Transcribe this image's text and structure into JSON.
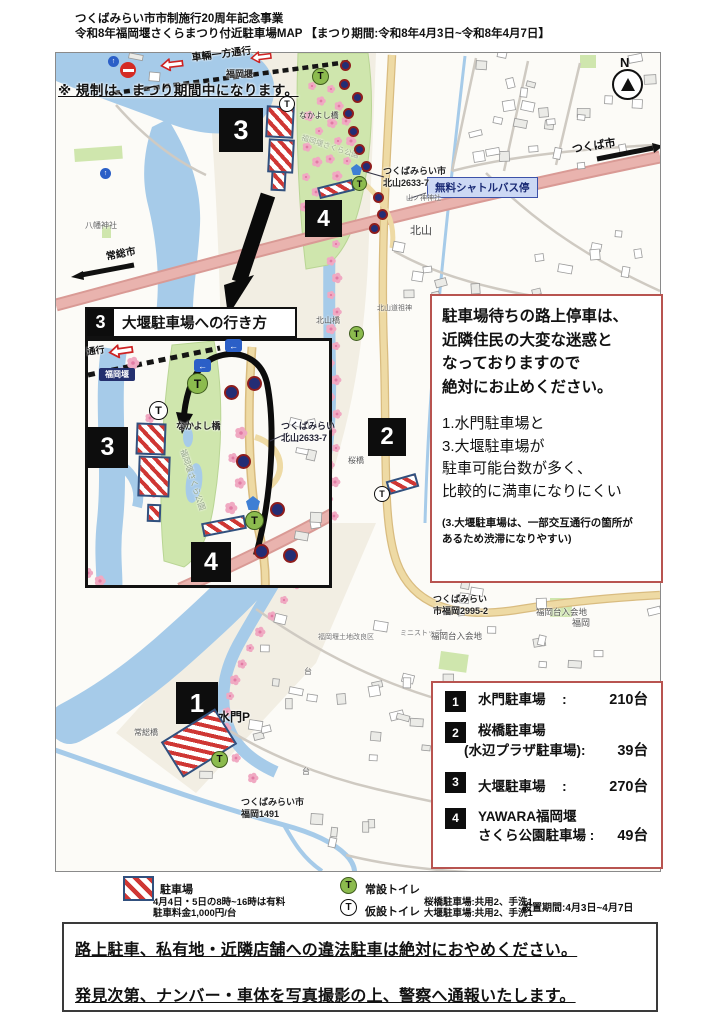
{
  "colors": {
    "accent_red_border": "#b85450",
    "badge_black": "#0d0d0d",
    "river_blue": "#a6cbe9",
    "park_green": "#cfe6ad",
    "highway_pink": "#e9b3ae",
    "road_yellow": "#eedaa4",
    "sakura_pink": "#f0a9c2",
    "hatch_red": "#cf3734",
    "toilet_green": "#8cbb4e",
    "shuttle_bg": "#ccd8f4",
    "shuttle_border": "#3c51a8"
  },
  "header": {
    "line1": "つくばみらい市市制施行20周年記念事業",
    "line2": "令和8年福岡堰さくらまつり付近駐車場MAP 【まつり期間:令和8年4月3日~令和8年4月7日】"
  },
  "map": {
    "restriction_note": "※ 規制は、まつり期間中になります。",
    "one_way_label": "車輛一方通行",
    "shuttle_stop": "無料シャトルバス停",
    "compass": "N",
    "badges": [
      "1",
      "2",
      "3",
      "4"
    ],
    "labels": [
      {
        "name": "fukuoka-weir",
        "text": "福岡堰"
      },
      {
        "name": "nakayoshi-bridge",
        "text": "なかよし橋"
      },
      {
        "name": "sakura-park",
        "text": "福岡堰さくら公園"
      },
      {
        "name": "address-kitayama",
        "text": "つくばみらい市\n北山2633-7"
      },
      {
        "name": "tsukuba-city",
        "text": "つくば市"
      },
      {
        "name": "kitayama",
        "text": "北山"
      },
      {
        "name": "yamanokami-shrine",
        "text": "山ノ神神社"
      },
      {
        "name": "hachiman-shrine",
        "text": "八幡神社"
      },
      {
        "name": "joso-city",
        "text": "常総市"
      },
      {
        "name": "kitayama-bridge",
        "text": "北山橋"
      },
      {
        "name": "kitayama-dosojin",
        "text": "北山道祖神"
      },
      {
        "name": "sakura-bridge",
        "text": "桜橋"
      },
      {
        "name": "address-fukuoka2995",
        "text": "つくばみらい\n市福岡2995-2"
      },
      {
        "name": "ministop",
        "text": "ミニストップ"
      },
      {
        "name": "fukuokadai-iriaichi-1",
        "text": "福岡台入会地"
      },
      {
        "name": "fukuokadai-iriaichi-2",
        "text": "福岡台入会地"
      },
      {
        "name": "fukuoka",
        "text": "福岡"
      },
      {
        "name": "land-improvement",
        "text": "福岡堰土地改良区"
      },
      {
        "name": "dai-1",
        "text": "台"
      },
      {
        "name": "dai-2",
        "text": "台"
      },
      {
        "name": "joso-bridge",
        "text": "常総橋"
      },
      {
        "name": "suimon-p",
        "text": "水門P"
      },
      {
        "name": "address-fukuoka1491",
        "text": "つくばみらい市\n福岡1491"
      }
    ]
  },
  "inset": {
    "badge": "3",
    "title": "大堰駐車場への行き方",
    "badges": [
      "3",
      "4"
    ],
    "labels": [
      {
        "name": "inset-oneway",
        "text": "通行"
      },
      {
        "name": "inset-nakayoshi",
        "text": "なかよし橋"
      },
      {
        "name": "inset-sakura-park",
        "text": "福岡堰さくら公園"
      },
      {
        "name": "inset-address",
        "text": "つくばみらい\n北山2633-7"
      }
    ],
    "weir_chip": "福岡堰"
  },
  "warning_box": {
    "para1": [
      "駐車場待ちの路上停車は、",
      "近隣住民の大変な迷惑と",
      "なっておりますので",
      "絶対にお止めください。"
    ],
    "para2": [
      "1.水門駐車場と",
      "3.大堰駐車場が",
      "駐車可能台数が多く、",
      "比較的に満車になりにくい"
    ],
    "para3": [
      "(3.大堰駐車場は、一部交互通行の箇所が",
      "あるため渋滞になりやすい)"
    ]
  },
  "parking_list": {
    "items": [
      {
        "no": "1",
        "name": "水門駐車場",
        "name2": "",
        "colon": ":",
        "count": "210台"
      },
      {
        "no": "2",
        "name": "桜橋駐車場",
        "name2": "(水辺プラザ駐車場):",
        "colon": "",
        "count": "39台"
      },
      {
        "no": "3",
        "name": "大堰駐車場",
        "name2": "",
        "colon": ":",
        "count": "270台"
      },
      {
        "no": "4",
        "name": "YAWARA福岡堰",
        "name2": "さくら公園駐車場 :",
        "colon": "",
        "count": "49台"
      }
    ]
  },
  "legend": {
    "toilet_letter": "T",
    "parking_label": "駐車場",
    "fee_line1": "4月4日・5日の8時~16時は有料",
    "fee_line2": "駐車料金1,000円/台",
    "permanent_toilet": "常設トイレ",
    "temporary_toilet": "仮設トイレ",
    "toilet_note1": "桜橋駐車場:共用2、手洗1",
    "toilet_note2": "大堰駐車場:共用2、手洗1",
    "period": "設置期間:4月3日~4月7日"
  },
  "bottom_warning": {
    "line1": "路上駐車、私有地・近隣店舗への違法駐車は絶対におやめください。",
    "line2": "発見次第、ナンバー・車体を写真撮影の上、警察へ通報いたします。"
  }
}
